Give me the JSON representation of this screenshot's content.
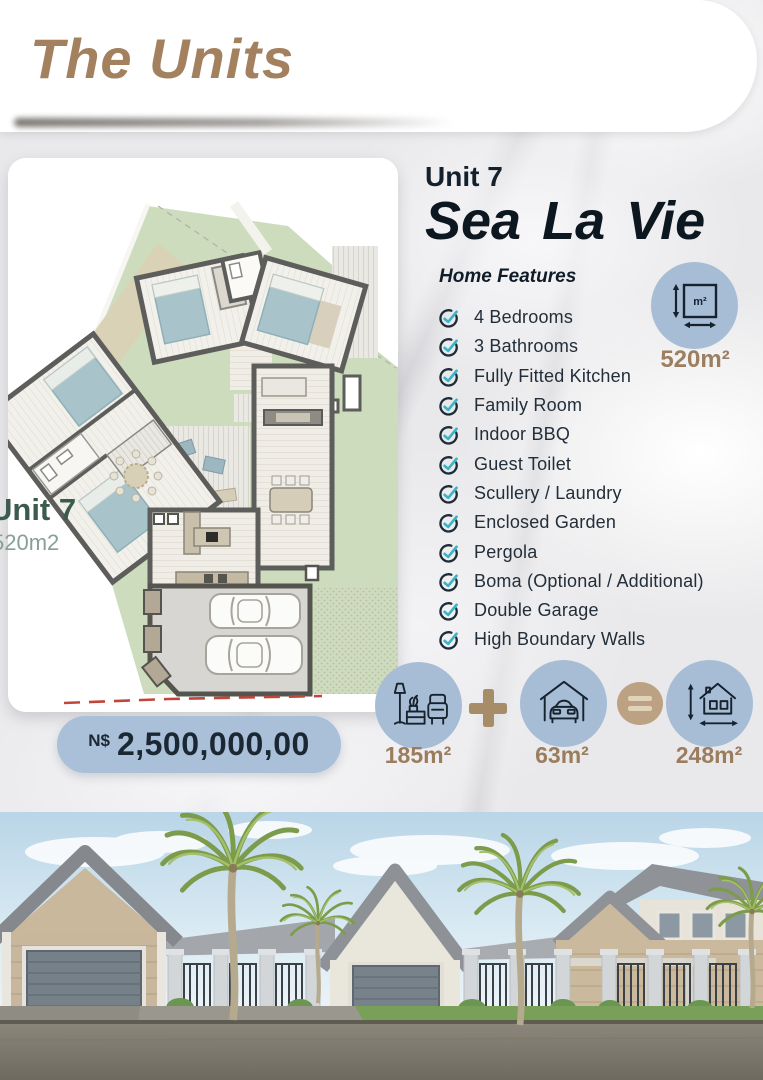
{
  "header": {
    "title": "The Units"
  },
  "unit": {
    "label": "Unit 7",
    "name": "Sea La Vie"
  },
  "features": {
    "heading": "Home Features",
    "items": [
      "4 Bedrooms",
      "3 Bathrooms",
      "Fully Fitted Kitchen",
      "Family Room",
      "Indoor BBQ",
      "Guest Toilet",
      "Scullery / Laundry",
      "Enclosed Garden",
      "Pergola",
      "Boma (Optional / Additional)",
      "Double Garage",
      "High Boundary Walls"
    ]
  },
  "stand": {
    "icon_label": "m²",
    "value": "520m²"
  },
  "plan": {
    "unit_label": "Unit 7",
    "area_label": "520m2"
  },
  "price": {
    "currency": "N$",
    "amount": "2,500,000,00"
  },
  "summary": {
    "house": "185m²",
    "plus": "+",
    "garage": "63m²",
    "equals": "=",
    "total": "248m²"
  },
  "colors": {
    "accent_brown": "#a3815f",
    "badge_blue": "#a7bdd5",
    "check_teal": "#3cb4c7",
    "text_dark": "#1b2733",
    "plan_green": "#ccdcbd"
  }
}
